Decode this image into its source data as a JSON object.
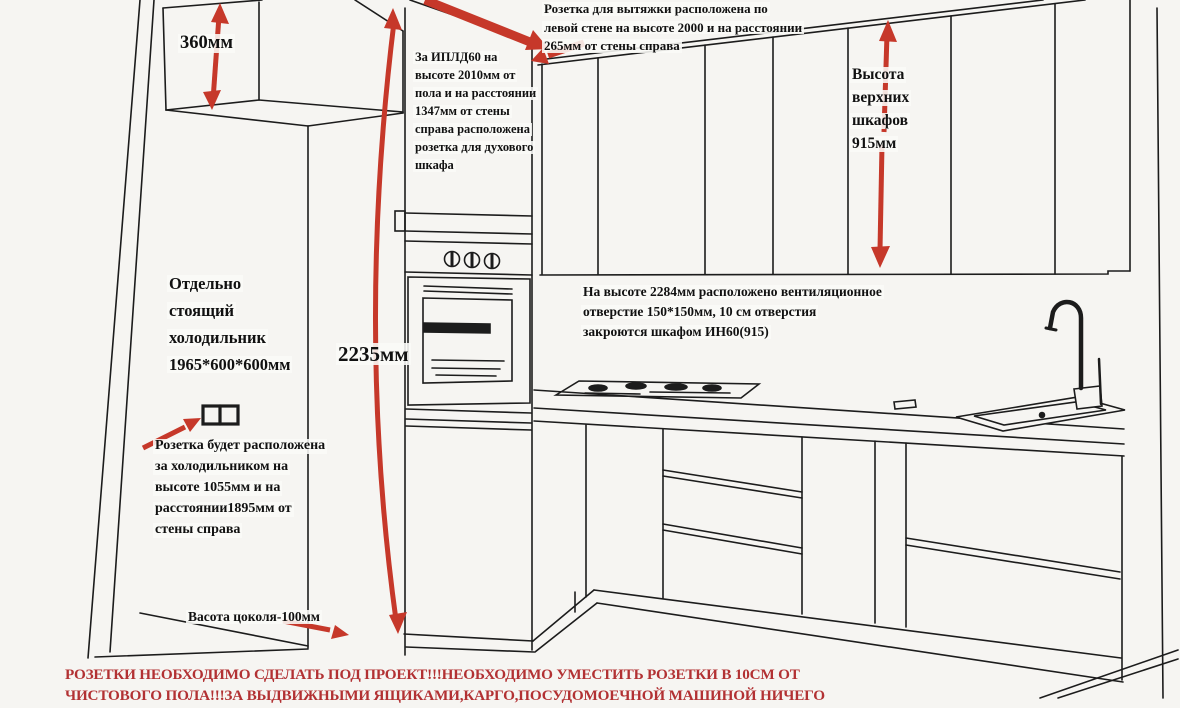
{
  "title": "Kitchen installation drawing with socket positions",
  "colors": {
    "background": "#f6f5f2",
    "line": "#1c1c1c",
    "arrow_red": "#c6382a",
    "warning_red": "#b23133"
  },
  "annotations": {
    "cabinet_depth": {
      "label": "360мм"
    },
    "hood_socket": {
      "lines": [
        "Розетка для вытяжки расположена по",
        "левой стене на высоте 2000 и на расстоянии",
        "265мм от стены справа"
      ]
    },
    "oven_socket": {
      "lines": [
        "За ИПЛД60 на",
        "высоте 2010мм от",
        "пола и на расстоянии",
        "1347мм от стены",
        "справа расположена",
        "розетка для духового",
        "шкафа"
      ]
    },
    "upper_cabinet_height": {
      "lines": [
        "Высота",
        "верхних",
        "шкафов",
        "915мм"
      ]
    },
    "fridge": {
      "lines": [
        "Отдельно",
        "стоящий",
        "холодильник",
        "1965*600*600мм"
      ]
    },
    "total_height": {
      "label": "2235мм"
    },
    "vent_hole": {
      "lines": [
        "На высоте 2284мм расположено вентиляционное",
        "отверстие 150*150мм, 10 см отверстия",
        "закроются шкафом ИН60(915)"
      ]
    },
    "fridge_socket": {
      "lines": [
        "Розетка будет расположена",
        "за холодильником на",
        "высоте 1055мм и на",
        "расстоянии1895мм от",
        "стены справа"
      ]
    },
    "plinth": {
      "label": "Васота цоколя-100мм"
    },
    "warning": {
      "lines": [
        "РОЗЕТКИ НЕОБХОДИМО СДЕЛАТЬ ПОД ПРОЕКТ!!!НЕОБХОДИМО УМЕСТИТЬ РОЗЕТКИ В 10СМ ОТ",
        "ЧИСТОВОГО ПОЛА!!!ЗА ВЫДВИЖНЫМИ ЯЩИКАМИ,КАРГО,ПОСУДОМОЕЧНОЙ МАШИНОЙ НИЧЕГО"
      ]
    }
  }
}
